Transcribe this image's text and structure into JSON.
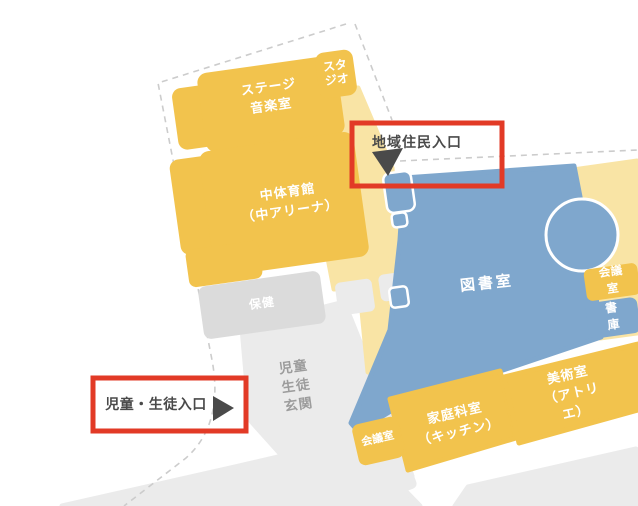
{
  "palette": {
    "yellow": "#F2C34D",
    "pale_yellow": "#F9E4A5",
    "blue": "#7FA7CD",
    "gray_block": "#DBDBDB",
    "ground": "#EBEBEB",
    "boundary": "#CCCCCC",
    "red": "#E23A26",
    "dark": "#4A4A4A",
    "muted_text": "#9C9C9C",
    "white": "#FFFFFF"
  },
  "rooms": {
    "stage_music": {
      "label": "ステージ\n音楽室"
    },
    "studio": {
      "label": "スタ\nジオ"
    },
    "gym": {
      "label": "中体育館\n（中アリーナ）"
    },
    "health": {
      "label": "保健"
    },
    "library": {
      "label": "図書室"
    },
    "meeting_room_east": {
      "label": "会議室"
    },
    "stacks": {
      "label": "書庫"
    },
    "home_ec": {
      "label": "家庭科室\n（キッチン）"
    },
    "art": {
      "label": "美術室\n（アトリエ）"
    },
    "meeting_room_south": {
      "label": "会議室"
    },
    "student_hall": {
      "label": "児童\n生徒\n玄関"
    }
  },
  "entrances": {
    "community": {
      "label": "地域住民入口",
      "marker": "triangle-down-left"
    },
    "students": {
      "label": "児童・生徒入口",
      "marker": "triangle-right"
    }
  }
}
